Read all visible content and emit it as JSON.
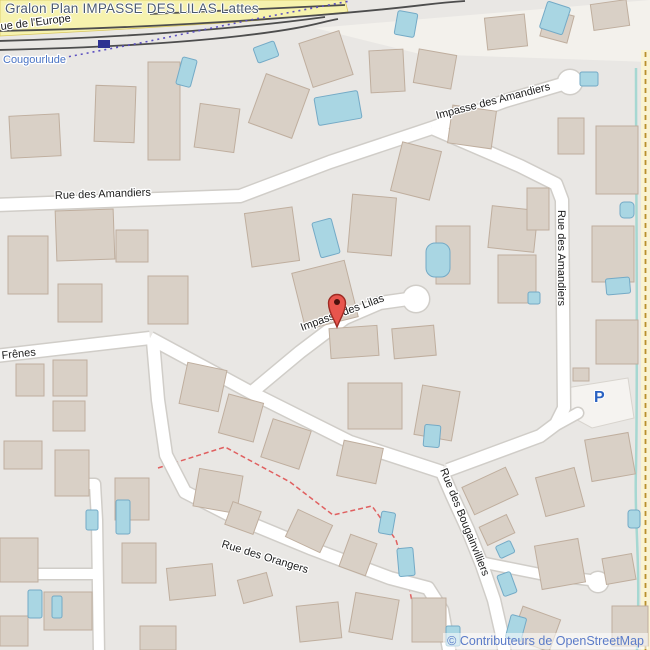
{
  "title": "Gralon Plan IMPASSE DES LILAS Lattes",
  "map": {
    "street_labels": {
      "rue_de_leurope": "ue de l'Europe",
      "cougourlude": "Cougourlude",
      "rue_des_amandiers_west": "Rue des Amandiers",
      "impasse_des_amandiers": "Impasse des Amandiers",
      "rue_des_amandiers_east": "Rue des Amandiers",
      "impasse_des_lilas": "Impasse des Lilas",
      "frenes": "Frênes",
      "rue_des_orangers": "Rue des Orangers",
      "rue_des_bougainvilliers": "Rue des Bougainvilliers"
    },
    "parking_symbol": "P",
    "attribution": "© Contributeurs de OpenStreetMap",
    "icons": {
      "marker": "location-pin-icon",
      "parking": "parking-icon"
    },
    "colors": {
      "land": "#e9e7e4",
      "road_fill": "#ffffff",
      "main_road_yellow": "#f6f2ae",
      "building_fill": "#d9d0c6",
      "pool_fill": "#a9d6e3",
      "stream_teal": "#a6d8d2",
      "railway_dark": "#4d4d4d",
      "boundary_purple": "#5b4fc0",
      "path_red": "#e06060",
      "track_dash_brown": "#b98f2e",
      "water_label_blue": "#4a74c4",
      "parking_blue": "#2a62c2",
      "attribution_blue": "#5b7bc8",
      "marker_red": "#e8554d",
      "title_color": "#4c5b6e"
    }
  }
}
